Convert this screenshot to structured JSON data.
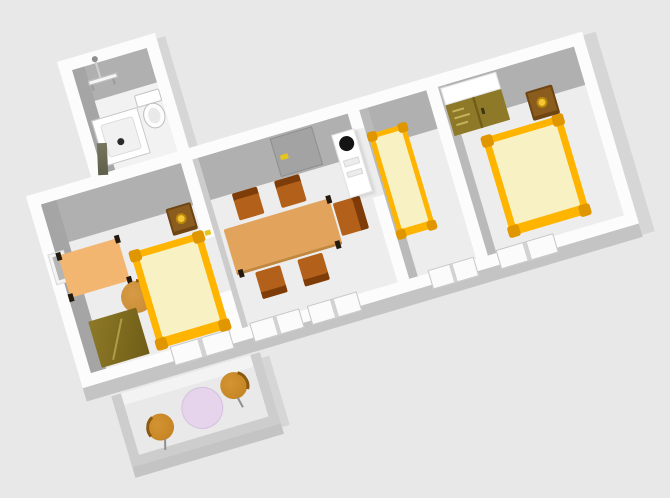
{
  "scene": {
    "type": "3d-aerial-apartment-floorplan",
    "rotation_deg": -16.5,
    "rooms": [
      {
        "name": "bathroom",
        "furniture": [
          "shower-tray",
          "toilet",
          "towel-rail",
          "shower-column",
          "open-door-leaf"
        ]
      },
      {
        "name": "bedroom-left",
        "furniture": [
          "wall-picture",
          "desk",
          "office-chair",
          "double-bed",
          "nightstand",
          "wardrobe"
        ]
      },
      {
        "name": "living-dining-room",
        "furniture": [
          "entrance-door",
          "dining-table",
          "dining-chair-1",
          "dining-chair-2",
          "dining-chair-3",
          "dining-chair-4",
          "dining-chair-5",
          "tall-appliance"
        ]
      },
      {
        "name": "bedroom-middle",
        "furniture": [
          "single-bed"
        ]
      },
      {
        "name": "bedroom-right",
        "furniture": [
          "wardrobe",
          "double-bed",
          "nightstand"
        ]
      },
      {
        "name": "balcony",
        "furniture": [
          "round-table",
          "patio-chair-1",
          "patio-chair-2"
        ]
      }
    ],
    "openings": [
      "entrance-door",
      "balcony-door-window",
      "living-window-1",
      "living-window-2",
      "middle-bedroom-window",
      "right-bedroom-window"
    ]
  },
  "palette": {
    "background": "#e8e8e8",
    "wall": "#fcfcfc",
    "inner_face": "#b0b0b0",
    "inner_face_side": "#a5a5a5",
    "inner_face_light": "#bababa",
    "floor": "#ededed",
    "floor_bath": "#f2f2f2",
    "shade": "#c4c4c4",
    "shade_light": "#d6d6d6",
    "parapet": "#cdcdcd",
    "balcony_floor": "#e9e9e9",
    "bed_frame": "#ffb400",
    "bed_post": "#e09600",
    "mattress": "#f7f1c3",
    "wardrobe": "#8d7928",
    "wardrobe_dark": "#6f5d18",
    "wardrobe_light": "#c3b35a",
    "table_wood": "#e2a45c",
    "chair": "#b2601a",
    "chair_dark": "#7e3c08",
    "desk": "#f2b671",
    "office_chair": "#d79a45",
    "nightstand": "#6e4513",
    "nightstand_top": "#8a5c1e",
    "knob": "#f4c636",
    "knob_ring": "#b8860b",
    "appliance": "#ffffff",
    "appliance_dot": "#141414",
    "door": "#a3a3a3",
    "door_frame": "#8f8f8f",
    "handle": "#e7c61b",
    "balcony_table": "#e6d3ec",
    "balcony_chair": "#d49433",
    "balcony_chair_dark": "#8a5a10",
    "window_frame": "#c6c6c6",
    "leg": "#241a10"
  }
}
